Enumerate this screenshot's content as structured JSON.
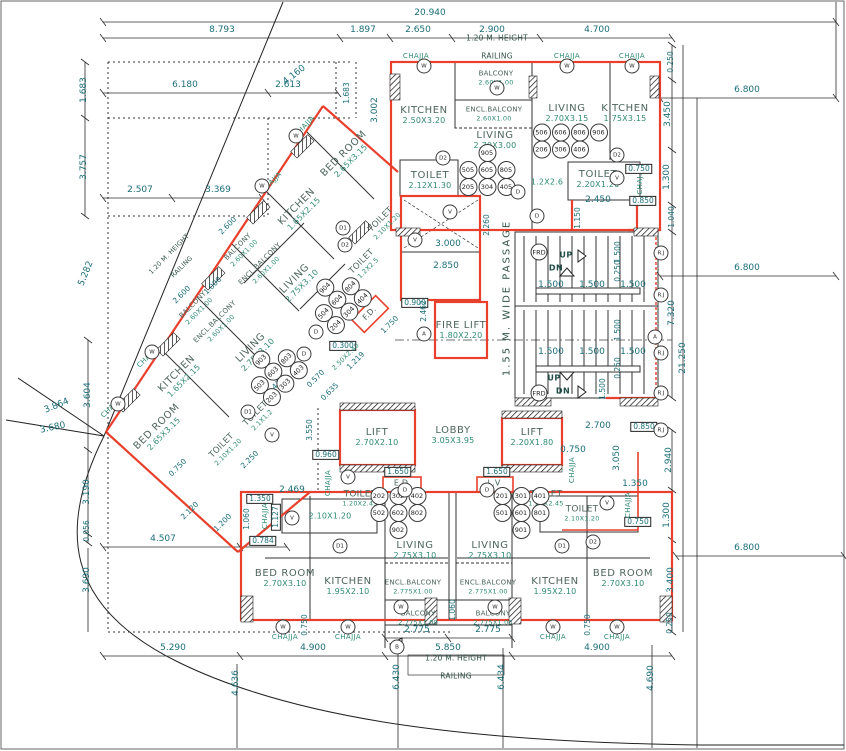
{
  "drawing": {
    "type": "building floor plan",
    "passage_label": "1.55 M. WIDE PASSAGE",
    "railing_note": {
      "line1": "1.20  M.  HEIGHT",
      "line2": "RAILING"
    },
    "chajja": "CHAJJA",
    "chaj_short": "CHAJ.",
    "colors": {
      "wall_red": "#e8402c",
      "dim_text": "#1b6e78",
      "room_size_text": "#2e8b74",
      "room_name_text": "#4d655c"
    }
  },
  "rooms": {
    "kitchen_tl": {
      "name": "KITCHEN",
      "size": "2.50X3.20"
    },
    "balcony_top": {
      "name": "BALCONY",
      "size": "2.60X1.00"
    },
    "encl_balcony_top": {
      "name": "ENCL.BALCONY",
      "size": "2.60X1.00"
    },
    "living_tc": {
      "name": "LIVING",
      "size": "2.70X3.00"
    },
    "living_tr": {
      "name": "LIVING",
      "size": "2.70X3.15"
    },
    "kitchen_tr": {
      "name": "KITCHEN",
      "size": "1.75X3.15"
    },
    "toilet_tc": {
      "name": "TOILET",
      "size": "2.12X1.30"
    },
    "toilet_tr": {
      "name": "TOILET",
      "size": "2.20X1.20"
    },
    "duct_tr": {
      "size": "1.2X2.6"
    },
    "fire_lift": {
      "name": "FIRE  LIFT",
      "size": "1.80X2.20"
    },
    "lift_left": {
      "name": "LIFT",
      "size": "2.70X2.10"
    },
    "lobby": {
      "name": "LOBBY",
      "size": "3.05X3.95"
    },
    "lift_right": {
      "name": "LIFT",
      "size": "2.20X1.80"
    },
    "ed": {
      "name": "E.D"
    },
    "lv": {
      "name": "L.V"
    },
    "toilet_bl_duct": {
      "name": "TOILET",
      "size": "1.20X2.45"
    },
    "toilet_bl": {
      "size": "2.10X1.20"
    },
    "toilet_br_duct": {
      "name": "TOILET",
      "size": "1.20X2.45"
    },
    "toilet_br": {
      "name": "TOILET",
      "size": "2.10X1.20"
    },
    "living_bl": {
      "name": "LIVING",
      "size": "2.75X3.10"
    },
    "living_br": {
      "name": "LIVING",
      "size": "2.75X3.10"
    },
    "kitchen_bl": {
      "name": "KITCHEN",
      "size": "1.95X2.10"
    },
    "kitchen_br": {
      "name": "KITCHEN",
      "size": "1.95X2.10"
    },
    "encl_balcony_bl": {
      "name": "ENCL.BALCONY",
      "size": "2.775X1.00"
    },
    "encl_balcony_br": {
      "name": "ENCL.BALCONY",
      "size": "2.775X1.00"
    },
    "balcony_bl": {
      "name": "BALCONY",
      "size": "2.775X1.00"
    },
    "balcony_br": {
      "name": "BALCONY",
      "size": "2.775X1.00"
    },
    "bedroom_bl": {
      "name": "BED  ROOM",
      "size": "2.70X3.10"
    },
    "bedroom_br": {
      "name": "BED  ROOM",
      "size": "2.70X3.10"
    },
    "bedroom_w1": {
      "name": "BED ROOM",
      "size": "2.65X3.15"
    },
    "kitchen_w1": {
      "name": "KITCHEN",
      "size": "1.65X2.15"
    },
    "toilet_w1": {
      "name": "TOILET",
      "size": "2.10X1.20"
    },
    "toilet_w1b": {
      "name": "TOILET",
      "size": "1.2X2.5"
    },
    "living_w1": {
      "name": "LIVING",
      "size": "2.75X3.10"
    },
    "balcony_w1": {
      "name": "BALCONY",
      "size": "2.60X1.00"
    },
    "encl_balcony_w1": {
      "name": "ENCL.BALCONY",
      "size": "2.60X1.00"
    },
    "balcony_w2": {
      "name": "BALCONY",
      "size": "2.60X1.00"
    },
    "encl_balcony_w2": {
      "name": "ENCL.BALCONY",
      "size": "2.60X1.00"
    },
    "living_w2": {
      "name": "LIVING",
      "size": "2.75X3.10"
    },
    "kitchen_w2": {
      "name": "KITCHEN",
      "size": "1.65X2.15"
    },
    "bedroom_w2": {
      "name": "BED ROOM",
      "size": "2.65X3.15"
    },
    "toilet_w2": {
      "name": "TOILET",
      "size": "2.10X1.20"
    },
    "toilet_w2b": {
      "name": "TOILET",
      "size": "2.1X1.2"
    },
    "fd": {
      "name": "F.D."
    },
    "room_w": {
      "size": "2.50X2.40"
    }
  },
  "dims": {
    "total": "20.940",
    "top": [
      "8.793",
      "1.897",
      "2.650",
      "2.900",
      "4.700"
    ],
    "upper": [
      "6.180",
      "2.613",
      "4.160",
      "1.683",
      "3.002",
      "1.683",
      "3.757",
      "2.507",
      "3.369"
    ],
    "left": [
      "5.282",
      "3.604",
      "3.864",
      "3.680",
      "3.190",
      "0.056",
      "4.507",
      "0.784",
      "3.690",
      "5.290",
      "4.636"
    ],
    "right": [
      "0.250",
      "3.450",
      "0.750",
      "1.300",
      "2.450",
      "0.850",
      "1.150",
      "1.040",
      "6.800",
      "7.320",
      "21.250",
      "6.800",
      "2.700",
      "0.850",
      "0.750",
      "3.050",
      "2.940",
      "1.350",
      "1.300",
      "0.750",
      "6.800",
      "3.400",
      "0.250",
      "4.690"
    ],
    "bottom": [
      "4.900",
      "5.850",
      "4.900",
      "2.775",
      "2.775",
      "6.430",
      "6.434",
      "1.060",
      "0.750",
      "0.750"
    ],
    "center": [
      "3.000",
      "2.850",
      "2.260",
      "0.900",
      "2.462",
      "0.300",
      "1.750",
      "1.219",
      "0.570",
      "0.635",
      "2.469",
      "0.960",
      "3.550",
      "1.350",
      "1.127",
      "1.060",
      "1.650",
      "1.650",
      "0.850"
    ],
    "wing": [
      "2.600",
      "2.600",
      "1.000",
      "1.475",
      "2.120",
      "1.200",
      "0.750",
      "2.250"
    ],
    "stair": {
      "tread": "1.500",
      "mid": "0.250"
    }
  },
  "units": {
    "tc": [
      [
        "905"
      ],
      [
        "505",
        "605",
        "805"
      ],
      [
        "205",
        "304",
        "405"
      ]
    ],
    "tr": [
      [
        "506",
        "606",
        "806",
        "906"
      ],
      [
        "206",
        "306",
        "406"
      ]
    ],
    "bl": [
      [
        "202",
        "302",
        "402"
      ],
      [
        "502",
        "602",
        "802"
      ],
      [
        "902"
      ]
    ],
    "br": [
      [
        "201",
        "301",
        "401"
      ],
      [
        "501",
        "601",
        "801"
      ],
      [
        "901"
      ]
    ],
    "w1": [
      [
        "904"
      ],
      [
        "504",
        "604",
        "804"
      ],
      [
        "204",
        "304",
        "404"
      ]
    ],
    "w2": [
      [
        "903"
      ],
      [
        "503",
        "603",
        "803"
      ],
      [
        "203",
        "303",
        "403"
      ]
    ]
  },
  "marks": {
    "w": "W",
    "v": "V",
    "d": "D",
    "d1": "D1",
    "d2": "D2",
    "b": "B",
    "a": "A",
    "frd": "FRD",
    "rj": "R.J",
    "up": "UP",
    "dn": "DN"
  }
}
